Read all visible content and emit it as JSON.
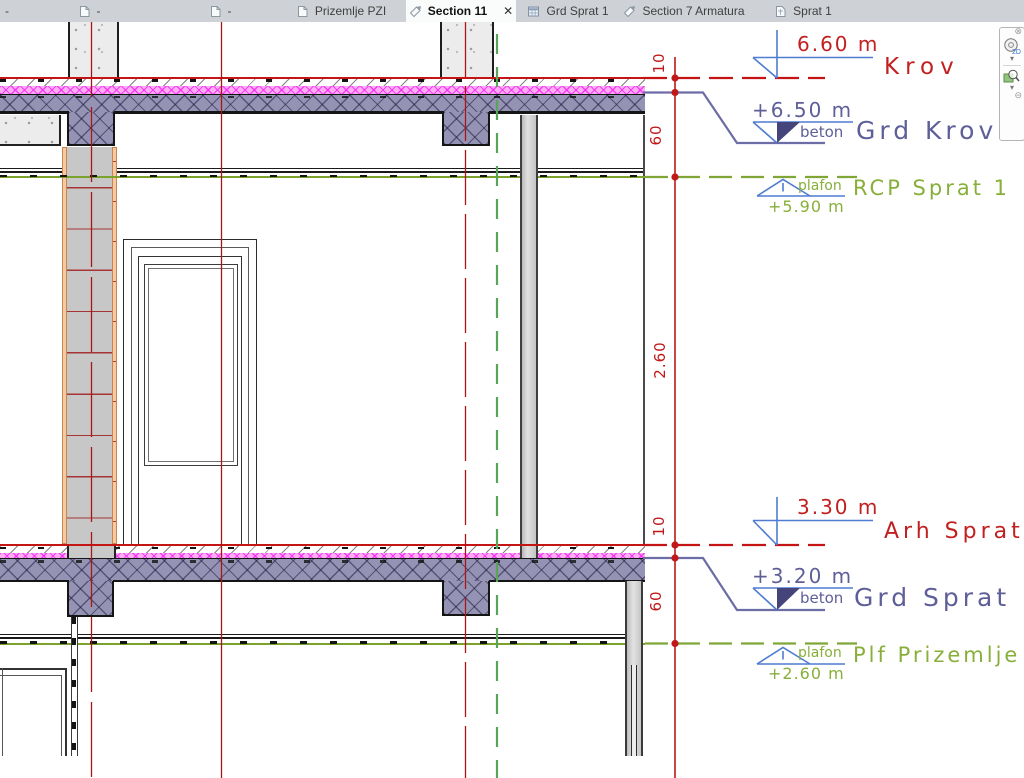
{
  "tabs": [
    {
      "label": "-"
    },
    {
      "label": "-"
    },
    {
      "label": "-"
    },
    {
      "label": "Prizemlje PZI"
    },
    {
      "label": "Section 11",
      "close": "✕"
    },
    {
      "label": "Grd Sprat 1"
    },
    {
      "label": "Section 7 Armatura"
    },
    {
      "label": "Sprat 1"
    }
  ],
  "levels": [
    {
      "name": "Krov",
      "elevation": "6.60 m"
    },
    {
      "name": "Grd Krov",
      "elevation": "+6.50 m",
      "material": "beton"
    },
    {
      "name": "RCP Sprat 1",
      "elevation": "+5.90 m",
      "note": "plafon"
    },
    {
      "name": "Arh Sprat 1",
      "elevation": "3.30 m"
    },
    {
      "name": "Grd Sprat 1",
      "elevation": "+3.20 m",
      "material": "beton"
    },
    {
      "name": "Plf Prizemlje",
      "elevation": "+2.60 m",
      "note": "plafon"
    }
  ],
  "dims": [
    "10",
    "60",
    "2.60",
    "10",
    "60"
  ],
  "nav": {
    "wheel_label": "2D"
  },
  "colors": {
    "annotation_red": "#c01818",
    "structure_slate": "#5e5e99",
    "finish_green": "#85ad39",
    "flag_blue": "#4f7cd0",
    "slab_purple": "#9593b3",
    "insulation_magenta": "#ff9df2"
  }
}
